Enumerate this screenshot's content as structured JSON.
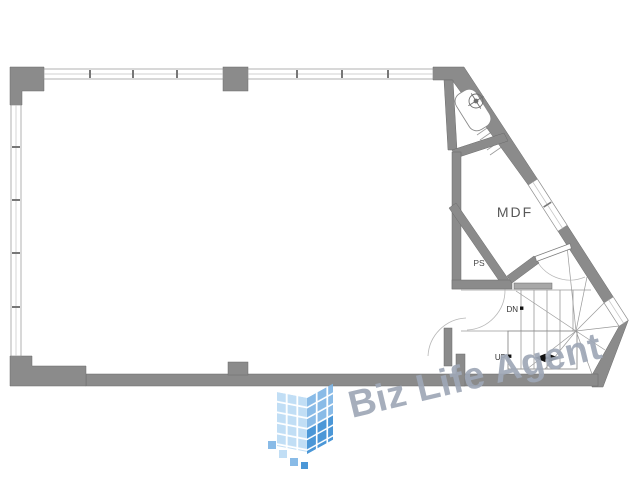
{
  "plan": {
    "wall_color": "#8b8b8b",
    "line_color": "#9a9a9a",
    "labels": {
      "mdf": "MDF",
      "ps": "PS",
      "down": "DN",
      "up": "UP"
    }
  },
  "watermark": {
    "text": "Biz Life Agent",
    "text_color": "#9fa8b7",
    "logo": {
      "tile_light": "#bcdcf5",
      "tile_mid": "#7fb6e6",
      "tile_dark": "#3c8fd4"
    }
  }
}
